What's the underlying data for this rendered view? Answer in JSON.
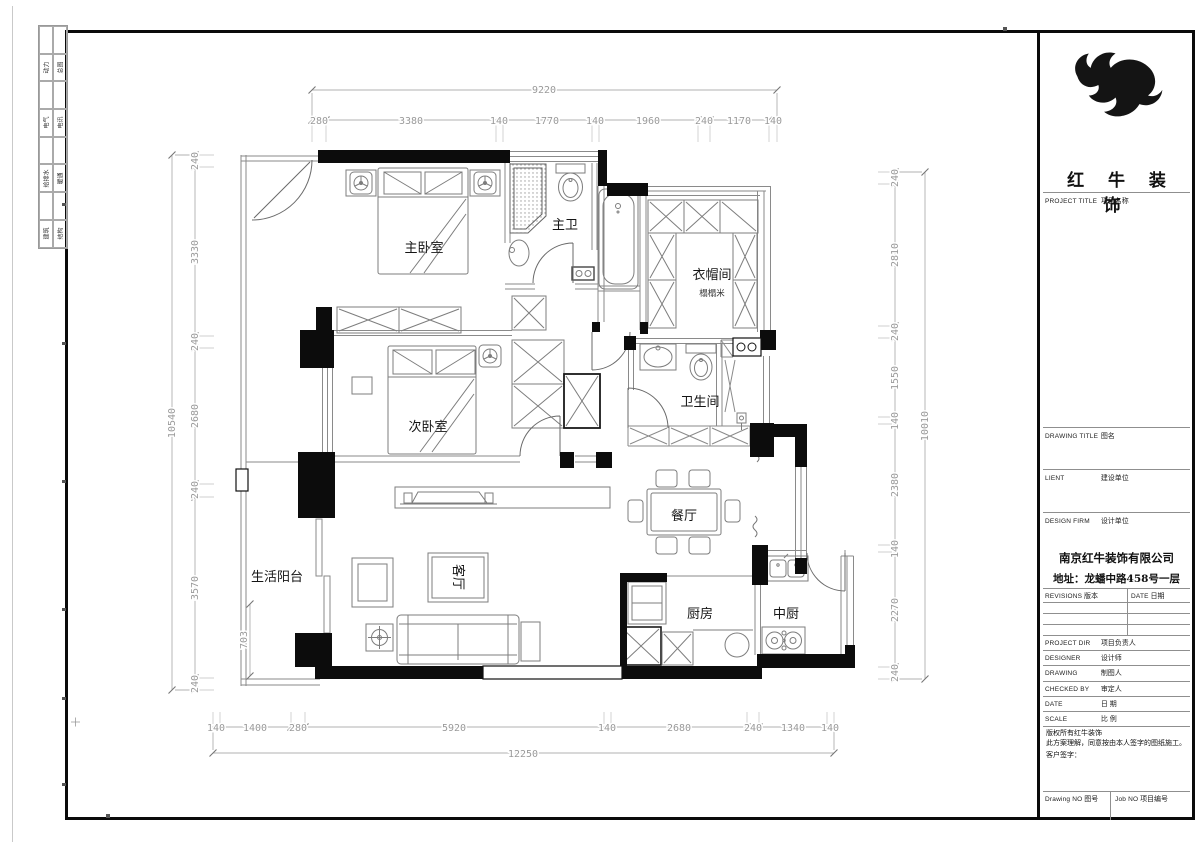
{
  "edge_strip": {
    "pairs": [
      [
        "动力",
        "总图"
      ],
      [
        "电气",
        "电讯"
      ],
      [
        "给排水",
        "暖通"
      ],
      [
        "建筑",
        "结构"
      ]
    ]
  },
  "titleblock": {
    "logo_text": "红 牛 装 饰",
    "project": {
      "en": "PROJECT TITLE",
      "cn": "项目名称"
    },
    "drawing": {
      "en": "DRAWING TITLE",
      "cn": "图名"
    },
    "client": {
      "en": "LIENT",
      "cn": "建设单位"
    },
    "design_firm": {
      "en": "DESIGN FIRM",
      "cn": "设计单位"
    },
    "company_name": "南京红牛装饰有限公司",
    "company_address": "地址：龙蟠中路458号一层",
    "revisions": {
      "en": "REVISIONS",
      "cn": "版本"
    },
    "date_col": {
      "en": "DATE",
      "cn": "日期"
    },
    "rows": [
      {
        "en": "PROJECT DIR",
        "cn": "项目负责人"
      },
      {
        "en": "DESIGNER",
        "cn": "设计师"
      },
      {
        "en": "DRAWING",
        "cn": "制图人"
      },
      {
        "en": "CHECKED BY",
        "cn": "审定人"
      },
      {
        "en": "DATE",
        "cn": "日 期"
      },
      {
        "en": "SCALE",
        "cn": "比 例"
      }
    ],
    "copyright_line1": "版权所有红牛装饰",
    "copyright_line2": "此方案理解，同意按由本人签字的图纸施工。",
    "customer_sign": "客户签字：",
    "drawing_no": {
      "en": "Drawing NO",
      "cn": "图号"
    },
    "job_no": {
      "en": "Job NO",
      "cn": "项目编号"
    }
  },
  "plan": {
    "rooms": {
      "master_bedroom": "主卧室",
      "master_bath": "主卫",
      "cloakroom": "衣帽间",
      "tatami": "榻榻米",
      "second_bedroom": "次卧室",
      "bathroom": "卫生间",
      "dining": "餐厅",
      "living": "客厅",
      "balcony": "生活阳台",
      "kitchen": "厨房",
      "chinese_kitchen": "中厨"
    },
    "dims": {
      "top": {
        "total": "9220",
        "segments": [
          "280",
          "3380",
          "140",
          "1770",
          "140",
          "1960",
          "240",
          "1170",
          "140"
        ]
      },
      "bottom": {
        "total": "12250",
        "segments": [
          "140",
          "1400",
          "280",
          "5920",
          "140",
          "2680",
          "240",
          "1340",
          "140"
        ]
      },
      "left": {
        "total": "10540",
        "segments": [
          "240",
          "3330",
          "240",
          "2680",
          "240",
          "3570",
          "240"
        ]
      },
      "right": {
        "total": "10010",
        "segments": [
          "240",
          "2810",
          "240",
          "1550",
          "140",
          "2380",
          "140",
          "2270",
          "240"
        ]
      },
      "extra": "703"
    }
  }
}
